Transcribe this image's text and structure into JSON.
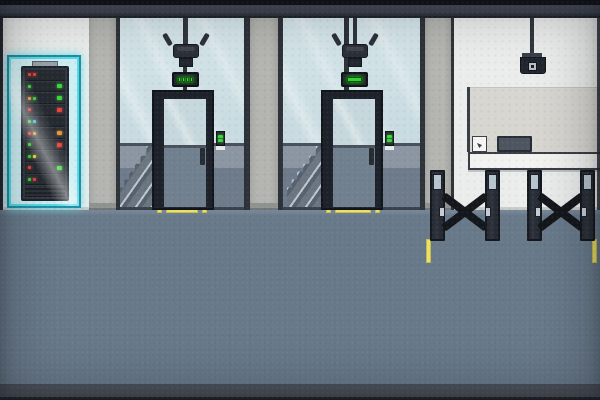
{
  "scene": {
    "title": "pixel-office-lobby",
    "palette": {
      "ceiling": "#3f4552",
      "ceiling_void": "#14161c",
      "wall_white": "#ebedec",
      "wall_reception_panel": "#d7d6d1",
      "pillar": "#b4b4b0",
      "mullion": "#2d3138",
      "glass": "#c9dce1",
      "wainscot": "#8b96a2",
      "behind_glass_floor": "#6d7b8a",
      "floor": "#68798a",
      "floor_dark_band": "#4c515b",
      "floor_edge": "#23262c",
      "door_frame": "#1d2129",
      "door_glass_lower": "#71808f",
      "accent_glow": "#55d9e8",
      "led_green": "#3ed63a",
      "led_red": "#e8453f",
      "led_orange": "#e8983c",
      "led_yellow": "#e8d43c",
      "led_teal": "#3ec8d8",
      "marking_yellow": "#ece066",
      "turnstile_post": "#2e333d",
      "turnstile_cap": "#b7c5d1",
      "desk": "#f2f3f1",
      "monitor": "#4e5560"
    },
    "server_rack": {
      "label": "server-rack",
      "glow_color": "#55d9e8",
      "rows": [
        {
          "left": [
            "#e8453f",
            "#e8453f"
          ],
          "right": null,
          "vent": false
        },
        {
          "left": [
            "#3ed63a"
          ],
          "right": "#3ed63a",
          "vent": false
        },
        {
          "left": [
            "#e8983c",
            "#3ed63a"
          ],
          "right": "#3ed63a",
          "vent": false
        },
        {
          "left": [
            "#e8453f"
          ],
          "right": "#e8453f",
          "vent": false
        },
        {
          "left": [
            "#3ed63a",
            "#3ec8d8"
          ],
          "right": null,
          "vent": false
        },
        {
          "left": [
            "#e8453f",
            "#e8983c"
          ],
          "right": "#e8983c",
          "vent": false
        },
        {
          "left": [
            "#3ed63a"
          ],
          "right": "#e8453f",
          "vent": false
        },
        {
          "left": [
            "#3ed63a",
            "#e8d43c"
          ],
          "right": null,
          "vent": false
        },
        {
          "left": [
            "#e8453f"
          ],
          "right": "#3ed63a",
          "vent": false
        },
        {
          "left": [
            "#3ed63a",
            "#e8453f"
          ],
          "right": null,
          "vent": false
        },
        {
          "left": [],
          "right": null,
          "vent": true
        }
      ]
    },
    "elevators": [
      {
        "id": "elevator-1",
        "door_state": "closed",
        "indicator": {
          "style": "segments",
          "segment_count": 4,
          "color": "#3ed63a"
        },
        "card_reader_leds": [
          "#3ed63a",
          "#3ed63a"
        ]
      },
      {
        "id": "elevator-2",
        "door_state": "closed",
        "indicator": {
          "style": "solid-bar",
          "segment_count": 1,
          "color": "#2fd232"
        },
        "card_reader_leds": [
          "#3ed63a",
          "#3ed63a"
        ]
      }
    ],
    "cameras": [
      {
        "id": "ceiling-camera-elevator-1",
        "type": "pronged"
      },
      {
        "id": "ceiling-camera-elevator-2",
        "type": "pronged"
      },
      {
        "id": "ceiling-camera-reception",
        "type": "dome"
      }
    ],
    "reception": {
      "label": "reception-desk",
      "items_on_desk": [
        "photo-frame",
        "monitor"
      ]
    },
    "turnstiles": {
      "count": 2,
      "state": "closed"
    },
    "floor_markings": [
      "elevator-1-strip",
      "elevator-2-strip",
      "turnstile-lane-left",
      "turnstile-lane-right"
    ]
  }
}
